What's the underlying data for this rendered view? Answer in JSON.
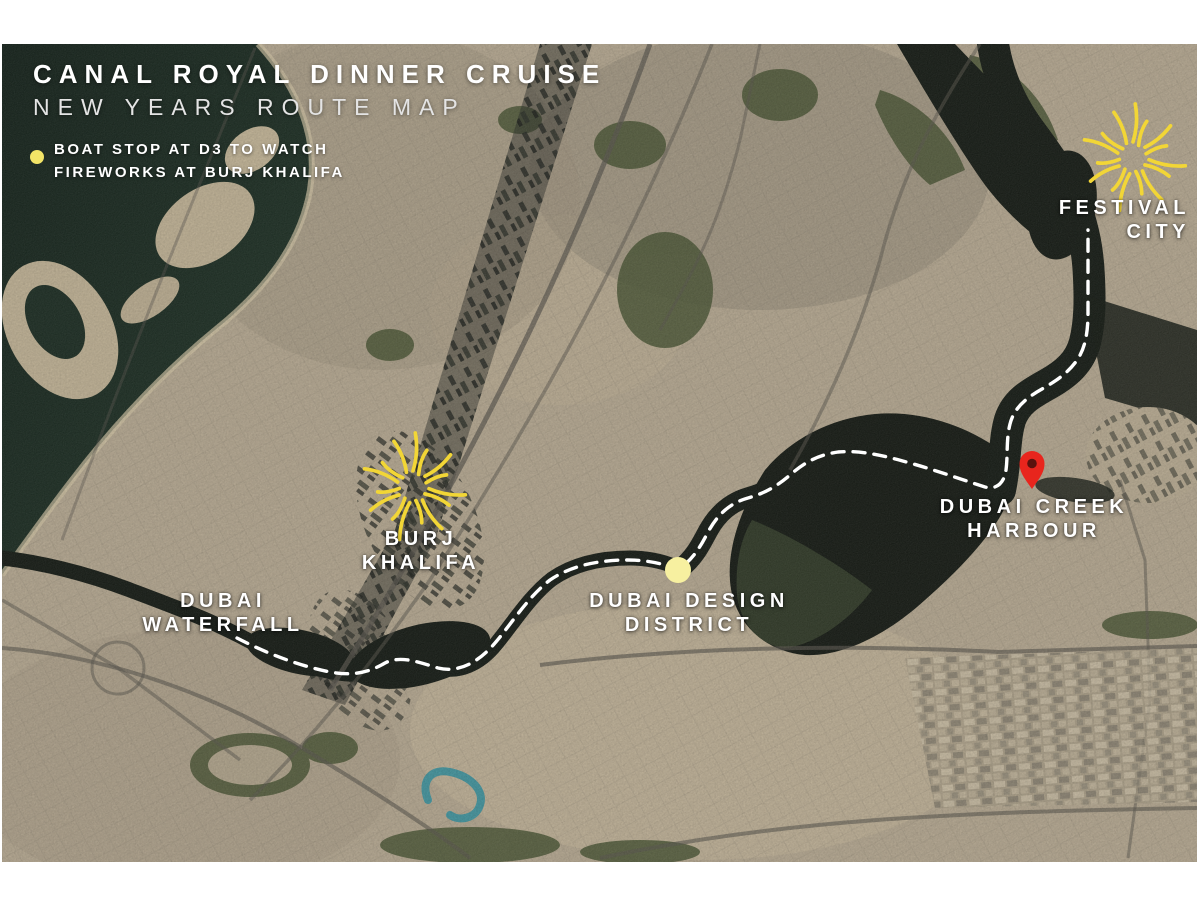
{
  "header": {
    "title": "CANAL ROYAL DINNER CRUISE",
    "subtitle": "NEW YEARS ROUTE MAP"
  },
  "legend": {
    "marker": "yellow-dot",
    "marker_color": "#f2e467",
    "line1": "BOAT STOP AT D3 TO WATCH",
    "line2": "FIREWORKS AT BURJ KHALIFA"
  },
  "map": {
    "style": "satellite",
    "labels": [
      {
        "id": "festival-city",
        "line1": "FESTIVAL",
        "line2": "CITY"
      },
      {
        "id": "dubai-creek-harbour",
        "line1": "DUBAI CREEK",
        "line2": "HARBOUR"
      },
      {
        "id": "burj-khalifa",
        "line1": "BURJ",
        "line2": "KHALIFA"
      },
      {
        "id": "dubai-design-district",
        "line1": "DUBAI DESIGN",
        "line2": "DISTRICT"
      },
      {
        "id": "dubai-waterfall",
        "line1": "DUBAI",
        "line2": "WATERFALL"
      }
    ],
    "markers": [
      {
        "id": "boat-stop-d3",
        "type": "yellow-dot",
        "color": "#f7f0a0",
        "near": "DUBAI DESIGN DISTRICT"
      },
      {
        "id": "destination-pin",
        "type": "red-pin",
        "color": "#e8251d",
        "near": "DUBAI CREEK HARBOUR"
      },
      {
        "id": "fireworks-burj-khalifa",
        "type": "fireworks-burst",
        "color": "#f2d636",
        "near": "BURJ KHALIFA"
      },
      {
        "id": "fireworks-festival-city",
        "type": "fireworks-burst",
        "color": "#f2d636",
        "near": "FESTIVAL CITY"
      }
    ],
    "route": {
      "style": "white-dashed-line",
      "from": "DUBAI WATERFALL",
      "stop": "DUBAI DESIGN DISTRICT (D3 boat stop)",
      "via": "DUBAI CREEK HARBOUR",
      "to": "FESTIVAL CITY"
    }
  },
  "colors": {
    "title_text": "#ffffff",
    "subtitle_text": "#e4e4e4",
    "route_line": "#ffffff",
    "sea_water": "#13231a",
    "land_base": "#b9ab92",
    "fireworks_yellow": "#f2d636",
    "pin_red": "#e8251d"
  }
}
